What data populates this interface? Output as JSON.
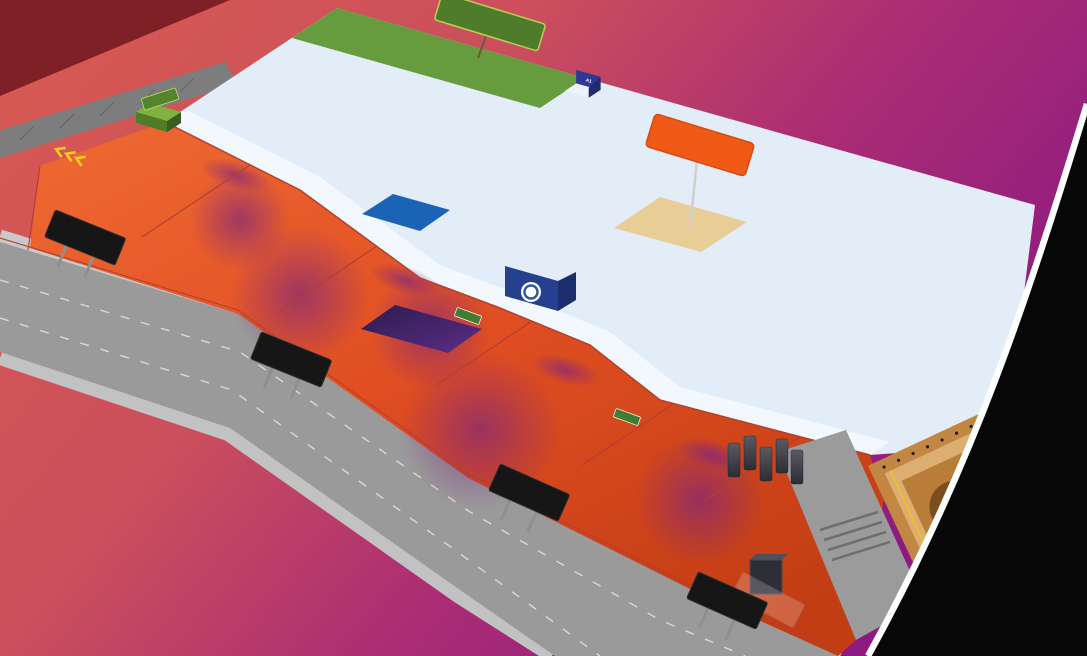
{
  "colors": {
    "bg_left": "#d85a51",
    "bg_right": "#8c1a80",
    "corner_wedge": "#7e2026",
    "black_corner": "#070707",
    "arc": "#ffffff",
    "road": "#9a9a9a",
    "sidewalk": "#c9c9c9",
    "wall": "#7d7d7d",
    "concourse_light": "#ef6a33",
    "concourse_dark": "#c23d14",
    "hall_floor": "#e2edf8",
    "walkway": "#f4f8fd",
    "cafeteria_green": "#669c3d",
    "b2b_floor": "#e9cd96",
    "b2b_border": "#f05a17",
    "fence": "#b04030",
    "bollard": "#5633a8",
    "escalator_red": "#d8232a",
    "theatre_gold": "#f2c31d",
    "theatre_wall": "#dcae72",
    "people": [
      "#191f3a",
      "#30323e",
      "#5b2d86",
      "#803b54",
      "#24456e",
      "#173a31",
      "#551b1b"
    ]
  },
  "booth_palette": [
    "#2c3a96",
    "#3d50b5",
    "#27338c",
    "#6a4bb0",
    "#8a5ac2",
    "#d84770",
    "#ef6f9a",
    "#c2185b",
    "#16aabc",
    "#4cc6dc",
    "#74cbf0",
    "#f3f7fb"
  ],
  "signs": {
    "cafeteria": {
      "label": "CAFETERIA",
      "bg": "#4e7c2a",
      "text_color": "#f2d21b"
    },
    "b2b": {
      "label": "B2B LOUNGE",
      "bg": "#f05a17",
      "text_color": "#ffffff"
    },
    "org_office": {
      "label": "ORG OFFICE"
    },
    "entry_20": {
      "line1": "ENTRY »",
      "line2": "GATE NO - 20"
    },
    "exit_19": {
      "line1": "« EXIT",
      "line2": "GATE NO - 19"
    },
    "entry_18": {
      "line1": "ENTRY »",
      "line2": "GATE NO - 18"
    },
    "exit_17": {
      "line1": "« EXIT",
      "line2": "GATE NO - 17"
    }
  },
  "floor_texts": {
    "restroom": "RESTROOM",
    "pavilion_1": "PAVILION 1",
    "pavilion_2": "PAVILION 2",
    "pavilion_3": "PAVILION 3",
    "way_to_registration_1": "« WAY TO",
    "way_to_registration_2": "REGISTRATION",
    "way_to_pavilion_1": "« WAY TO",
    "way_to_pavilion_2": "PAVILION",
    "drop_off_20": "DROP OFF POINT OF GATE NO - 20",
    "drop_off_18": "DROP OFF POINT OF GATE NO - 18",
    "to_basement": "TO BASEMENT PARKING »",
    "way_theatre": "WAY TOWARDS GRAND THEATRE »",
    "elevator_hall": "ELEVATOR FOR L0 & L9 HALL",
    "large_elevator_1": "LARGE",
    "large_elevator_2": "ELEVATOR",
    "grand_theatre": "THE GR",
    "exit_board": "EXIT",
    "gff": "#GFF",
    "npci": "NPCI"
  },
  "escalator_labels": [
    "« GATE 20 »",
    "« GATE 19 »",
    "« GATE 18 »",
    "« GATE 17 »"
  ],
  "booth_codes": [
    "A1",
    "A5",
    "K7",
    "E3",
    "D2",
    "N3",
    "Q4",
    "K5",
    "M4 M5",
    "L24",
    "F3",
    "P3",
    "U.M",
    "B2",
    "C6",
    "J2",
    "G8",
    "H4",
    "R2",
    "S5",
    "K4 K5",
    "A4 A5",
    "Q23",
    "D23",
    "T7",
    "W6"
  ],
  "cars": [
    "#e8c220",
    "#2e6fc4",
    "#8e1f2a",
    "#17808c",
    "#d63030",
    "#741722"
  ]
}
